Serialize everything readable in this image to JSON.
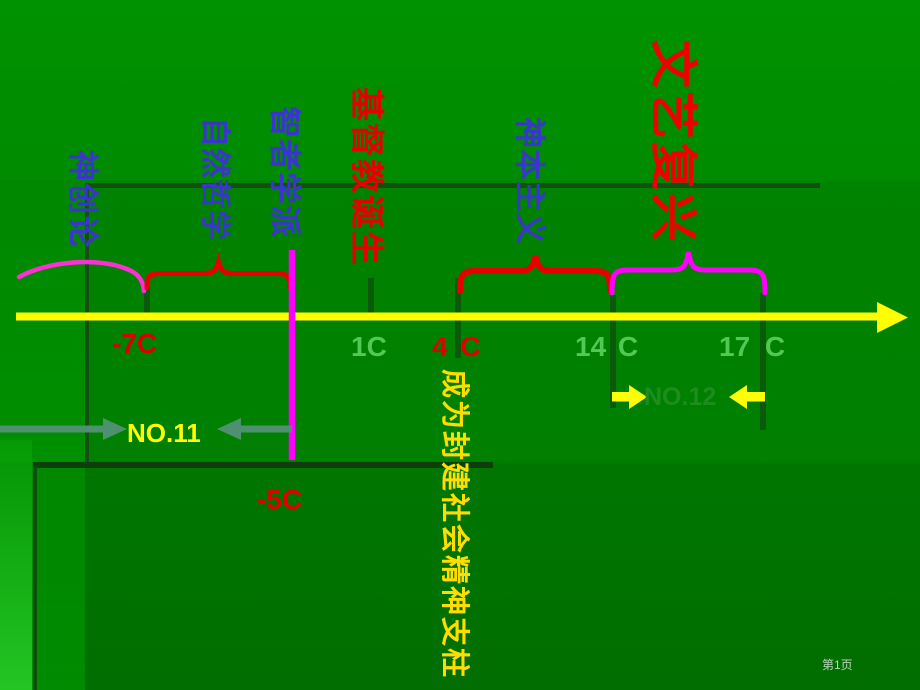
{
  "slide": {
    "page_number": "第1页"
  },
  "eras": {
    "creationism": "神创论",
    "natural_philosophy": "自然哲学",
    "sophists": "智者学派",
    "christianity_birth": "基督教诞生",
    "theocentrism": "神本主义",
    "renaissance": "文艺复兴"
  },
  "axis": {
    "c_minus7": "-7C",
    "c_1": "1C",
    "c_4": "4 C",
    "c_14": "14 C",
    "c_17": "17 C",
    "c_minus5": "-5C"
  },
  "annotations": {
    "no11": "NO.11",
    "no12": "NO.12",
    "pillar": "成为封建社会精神支柱"
  },
  "colors": {
    "background_green": "#008300",
    "panel_line_dark": "#134e13",
    "axis_yellow": "#ffff00",
    "tick_dark_green": "#0a5a0a",
    "era_label_blue": "#3a35cc",
    "era_label_red": "#e60000",
    "century_green": "#54c854",
    "century_red": "#d80000",
    "divider_magenta": "#ff00ff",
    "arc_pink": "#ff2fd8",
    "gray_arrow": "#4f9070",
    "no12_text_green": "#1e8c1e",
    "pillar_yellow": "#ffdd00",
    "page_number_gray": "#bfd3bf"
  }
}
